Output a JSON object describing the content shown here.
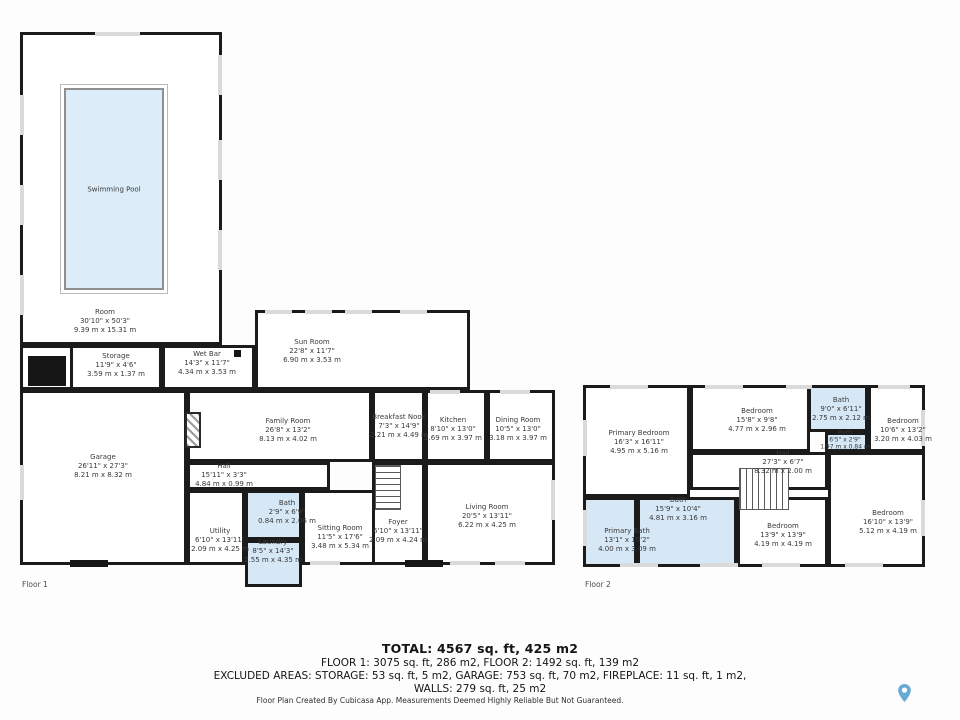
{
  "floor1": {
    "label": "Floor 1",
    "rooms": [
      {
        "name": "Swimming Pool",
        "imperial": "",
        "metric": ""
      },
      {
        "name": "Room",
        "imperial": "30'10\" x 50'3\"",
        "metric": "9.39 m x 15.31 m"
      },
      {
        "name": "Storage",
        "imperial": "11'9\" x 4'6\"",
        "metric": "3.59 m x 1.37 m"
      },
      {
        "name": "Wet Bar",
        "imperial": "14'3\" x 11'7\"",
        "metric": "4.34 m x 3.53 m"
      },
      {
        "name": "Sun Room",
        "imperial": "22'8\" x 11'7\"",
        "metric": "6.90 m x 3.53 m"
      },
      {
        "name": "Garage",
        "imperial": "26'11\" x 27'3\"",
        "metric": "8.21 m x 8.32 m"
      },
      {
        "name": "Family Room",
        "imperial": "26'8\" x 13'2\"",
        "metric": "8.13 m x 4.02 m"
      },
      {
        "name": "Breakfast Nook",
        "imperial": "7'3\" x 14'9\"",
        "metric": "2.21 m x 4.49 m"
      },
      {
        "name": "Kitchen",
        "imperial": "8'10\" x 13'0\"",
        "metric": "2.69 m x 3.97 m"
      },
      {
        "name": "Dining Room",
        "imperial": "10'5\" x 13'0\"",
        "metric": "3.18 m x 3.97 m"
      },
      {
        "name": "Hall",
        "imperial": "15'11\" x 3'3\"",
        "metric": "4.84 m x 0.99 m"
      },
      {
        "name": "Utility",
        "imperial": "6'10\" x 13'11\"",
        "metric": "2.09 m x 4.25 m"
      },
      {
        "name": "Bath",
        "imperial": "2'9\" x 6'9\"",
        "metric": "0.84 m x 2.06 m"
      },
      {
        "name": "Laundry",
        "imperial": "8'5\" x 14'3\"",
        "metric": "2.55 m x 4.35 m"
      },
      {
        "name": "Sitting Room",
        "imperial": "11'5\" x 17'6\"",
        "metric": "3.48 m x 5.34 m"
      },
      {
        "name": "Foyer",
        "imperial": "6'10\" x 13'11\"",
        "metric": "2.09 m x 4.24 m"
      },
      {
        "name": "Living Room",
        "imperial": "20'5\" x 13'11\"",
        "metric": "6.22 m x 4.25 m"
      }
    ]
  },
  "floor2": {
    "label": "Floor 2",
    "rooms": [
      {
        "name": "Primary Bedroom",
        "imperial": "16'3\" x 16'11\"",
        "metric": "4.95 m x 5.16 m"
      },
      {
        "name": "Bedroom",
        "imperial": "15'8\" x 9'8\"",
        "metric": "4.77 m x 2.96 m"
      },
      {
        "name": "Bath",
        "imperial": "9'0\" x 6'11\"",
        "metric": "2.75 m x 2.12 m"
      },
      {
        "name": "Bedroom",
        "imperial": "10'6\" x 13'2\"",
        "metric": "3.20 m x 4.03 m"
      },
      {
        "name": "Bath",
        "imperial": "6'5\" x 2'9\"",
        "metric": "1.97 m x 0.84 m"
      },
      {
        "name": "Hall",
        "imperial": "27'3\" x 6'7\"",
        "metric": "8.32 m x 2.00 m"
      },
      {
        "name": "Bath",
        "imperial": "15'9\" x 10'4\"",
        "metric": "4.81 m x 3.16 m"
      },
      {
        "name": "Primary Bath",
        "imperial": "13'1\" x 10'2\"",
        "metric": "4.00 m x 3.09 m"
      },
      {
        "name": "Bedroom",
        "imperial": "13'9\" x 13'9\"",
        "metric": "4.19 m x 4.19 m"
      },
      {
        "name": "Bedroom",
        "imperial": "16'10\" x 13'9\"",
        "metric": "5.12 m x 4.19 m"
      }
    ]
  },
  "summary": {
    "total": "TOTAL: 4567 sq. ft, 425 m2",
    "floors": "FLOOR 1: 3075 sq. ft, 286 m2, FLOOR 2: 1492 sq. ft, 139 m2",
    "excluded": "EXCLUDED AREAS: STORAGE: 53 sq. ft, 5 m2, GARAGE: 753 sq. ft, 70 m2, FIREPLACE: 11 sq. ft, 1 m2,",
    "walls": "WALLS: 279 sq. ft, 25 m2",
    "footer": "Floor Plan Created By Cubicasa App. Measurements Deemed Highly Reliable But Not Guaranteed."
  },
  "colors": {
    "wall": "#1b1b1b",
    "water_fill": "#dcedf9",
    "bath_fill": "#d6e7f6",
    "window": "#dadada",
    "logo": "#67aad6"
  },
  "icons": {
    "logo": "map-pin-icon"
  }
}
